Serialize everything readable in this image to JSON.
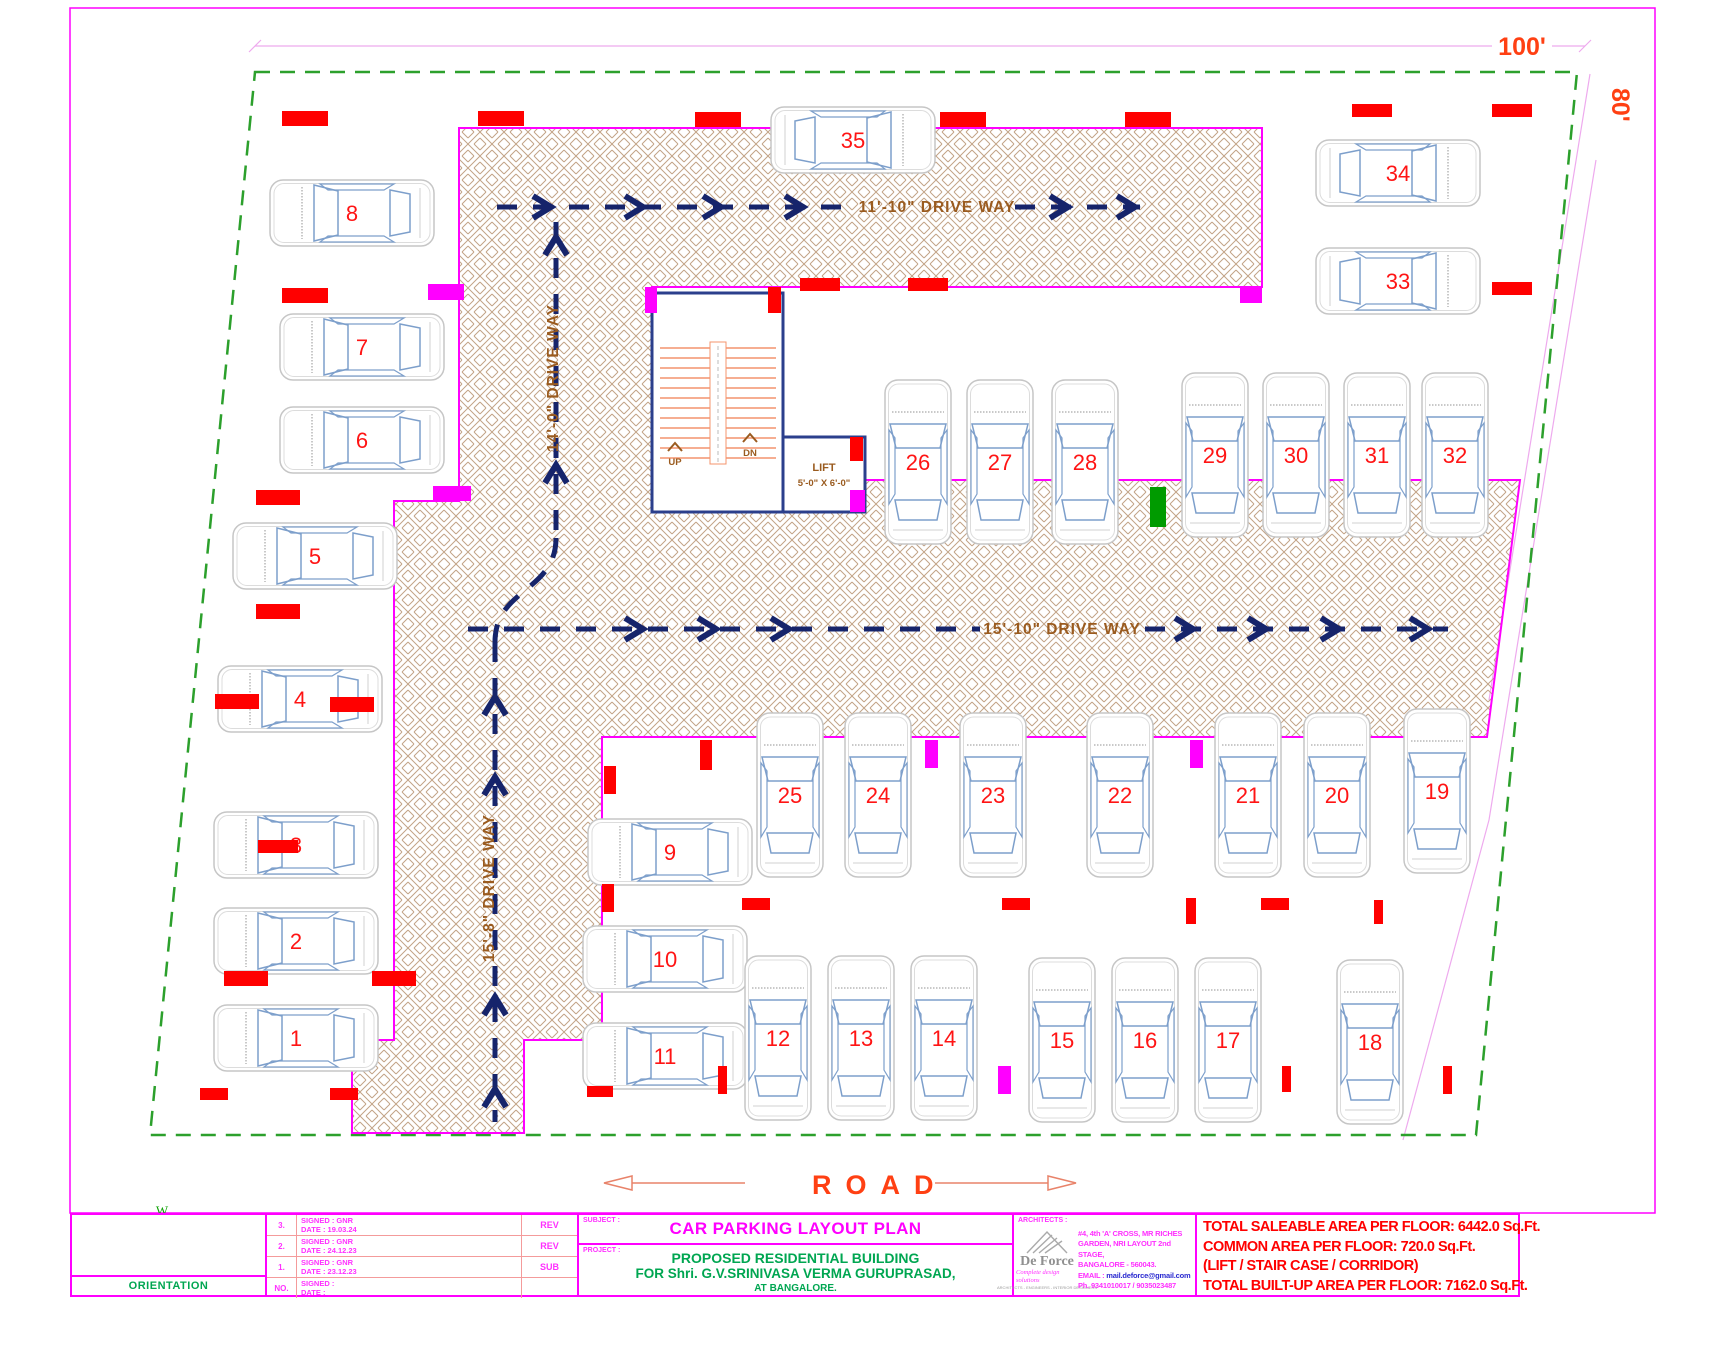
{
  "colors": {
    "magenta": "#ff00ff",
    "red": "#ff0000",
    "boundary_green": "#2ca02c",
    "column_green": "#009b00",
    "arrow_navy": "#16246b",
    "wall_navy": "#2b3f8c",
    "label_brown": "#9a5b1f",
    "hatch_tan": "#c2a386",
    "dim_pink": "#eeaaee",
    "orange_red": "#ff4013",
    "project_green": "#00a651",
    "car_gray": "#c6c6c6",
    "car_glass": "#7d9fcb"
  },
  "dims": {
    "top_label": "100'",
    "right_label": "80'"
  },
  "road": {
    "label": "ROAD"
  },
  "stair": {
    "up": "UP",
    "dn": "DN"
  },
  "lift": {
    "name": "LIFT",
    "size": "5'-0\" X 6'-0\""
  },
  "plan": {
    "driveway_labels": [
      {
        "label": "11'-10\" DRIVE WAY",
        "x": 937,
        "y": 212,
        "r": 0
      },
      {
        "label": "14'-0\" DRIVE WAY",
        "x": 558,
        "y": 378,
        "r": -90
      },
      {
        "label": "15'-10\" DRIVE WAY",
        "x": 1062,
        "y": 634,
        "r": 0
      },
      {
        "label": "15'-8\" DRIVE WAY",
        "x": 494,
        "y": 888,
        "r": -90
      }
    ],
    "spots": [
      [
        1,
        296,
        1038,
        "h",
        0
      ],
      [
        2,
        296,
        941,
        "h",
        0
      ],
      [
        3,
        296,
        845,
        "h",
        0
      ],
      [
        4,
        300,
        699,
        "h",
        0
      ],
      [
        5,
        315,
        556,
        "h",
        0
      ],
      [
        6,
        362,
        440,
        "h",
        0
      ],
      [
        7,
        362,
        347,
        "h",
        0
      ],
      [
        8,
        352,
        213,
        "h",
        0
      ],
      [
        9,
        670,
        852,
        "h",
        0
      ],
      [
        10,
        665,
        959,
        "h",
        0
      ],
      [
        11,
        665,
        1056,
        "h",
        0
      ],
      [
        12,
        778,
        1038,
        "v",
        0
      ],
      [
        13,
        861,
        1038,
        "v",
        0
      ],
      [
        14,
        944,
        1038,
        "v",
        0
      ],
      [
        15,
        1062,
        1040,
        "v",
        0
      ],
      [
        16,
        1145,
        1040,
        "v",
        0
      ],
      [
        17,
        1228,
        1040,
        "v",
        0
      ],
      [
        18,
        1370,
        1042,
        "v",
        0
      ],
      [
        19,
        1437,
        791,
        "v",
        0
      ],
      [
        20,
        1337,
        795,
        "v",
        0
      ],
      [
        21,
        1248,
        795,
        "v",
        0
      ],
      [
        22,
        1120,
        795,
        "v",
        0
      ],
      [
        23,
        993,
        795,
        "v",
        0
      ],
      [
        24,
        878,
        795,
        "v",
        0
      ],
      [
        25,
        790,
        795,
        "v",
        0
      ],
      [
        26,
        918,
        462,
        "v",
        0
      ],
      [
        27,
        1000,
        462,
        "v",
        0
      ],
      [
        28,
        1085,
        462,
        "v",
        0
      ],
      [
        29,
        1215,
        455,
        "v",
        0
      ],
      [
        30,
        1296,
        455,
        "v",
        0
      ],
      [
        31,
        1377,
        455,
        "v",
        0
      ],
      [
        32,
        1455,
        455,
        "v",
        0
      ],
      [
        33,
        1398,
        281,
        "h",
        1
      ],
      [
        34,
        1398,
        173,
        "h",
        1
      ],
      [
        35,
        853,
        140,
        "h",
        1
      ]
    ],
    "columns": [
      [
        282,
        111,
        46,
        15,
        "R"
      ],
      [
        478,
        111,
        46,
        15,
        "R"
      ],
      [
        695,
        112,
        46,
        15,
        "R"
      ],
      [
        940,
        112,
        46,
        15,
        "R"
      ],
      [
        1125,
        112,
        46,
        15,
        "R"
      ],
      [
        1352,
        104,
        40,
        13,
        "R"
      ],
      [
        1492,
        104,
        40,
        13,
        "R"
      ],
      [
        1492,
        282,
        40,
        13,
        "R"
      ],
      [
        282,
        288,
        46,
        15,
        "R"
      ],
      [
        428,
        284,
        36,
        16,
        "M"
      ],
      [
        256,
        490,
        44,
        15,
        "R"
      ],
      [
        433,
        486,
        38,
        15,
        "M"
      ],
      [
        256,
        604,
        44,
        15,
        "R"
      ],
      [
        215,
        694,
        44,
        15,
        "R"
      ],
      [
        330,
        697,
        44,
        15,
        "R"
      ],
      [
        258,
        840,
        40,
        13,
        "R"
      ],
      [
        224,
        971,
        44,
        15,
        "R"
      ],
      [
        372,
        971,
        44,
        15,
        "R"
      ],
      [
        200,
        1088,
        28,
        12,
        "R"
      ],
      [
        330,
        1088,
        28,
        12,
        "R"
      ],
      [
        645,
        287,
        12,
        26,
        "M"
      ],
      [
        768,
        287,
        13,
        26,
        "R"
      ],
      [
        800,
        278,
        40,
        13,
        "R"
      ],
      [
        908,
        278,
        40,
        13,
        "R"
      ],
      [
        1240,
        287,
        22,
        16,
        "M"
      ],
      [
        850,
        437,
        13,
        24,
        "R"
      ],
      [
        850,
        490,
        15,
        22,
        "M"
      ],
      [
        1150,
        487,
        16,
        40,
        "G"
      ],
      [
        604,
        766,
        12,
        28,
        "R"
      ],
      [
        700,
        740,
        12,
        30,
        "R"
      ],
      [
        925,
        740,
        13,
        28,
        "M"
      ],
      [
        1190,
        740,
        13,
        28,
        "M"
      ],
      [
        742,
        898,
        28,
        12,
        "R"
      ],
      [
        1002,
        898,
        28,
        12,
        "R"
      ],
      [
        1186,
        898,
        10,
        26,
        "R"
      ],
      [
        1261,
        898,
        28,
        12,
        "R"
      ],
      [
        1374,
        900,
        9,
        24,
        "R"
      ],
      [
        602,
        884,
        12,
        28,
        "R"
      ],
      [
        998,
        1066,
        13,
        28,
        "M"
      ],
      [
        718,
        1066,
        9,
        28,
        "R"
      ],
      [
        1282,
        1066,
        9,
        26,
        "R"
      ],
      [
        1443,
        1066,
        9,
        28,
        "R"
      ],
      [
        587,
        1086,
        26,
        11,
        "R"
      ]
    ],
    "chevrons": [
      [
        548,
        207,
        0
      ],
      [
        640,
        207,
        0
      ],
      [
        718,
        207,
        0
      ],
      [
        800,
        207,
        0
      ],
      [
        1065,
        207,
        0
      ],
      [
        1132,
        207,
        0
      ],
      [
        556,
        240,
        -90
      ],
      [
        556,
        468,
        -90
      ],
      [
        495,
        700,
        -90
      ],
      [
        495,
        780,
        -90
      ],
      [
        495,
        1000,
        -90
      ],
      [
        495,
        1092,
        -90
      ],
      [
        640,
        629,
        0
      ],
      [
        713,
        629,
        0
      ],
      [
        786,
        629,
        0
      ],
      [
        1190,
        629,
        0
      ],
      [
        1263,
        629,
        0
      ],
      [
        1336,
        629,
        0
      ],
      [
        1425,
        629,
        0
      ]
    ]
  },
  "titleblock": {
    "orientation_label": "ORIENTATION",
    "compass": {
      "w": "W",
      "n": "N",
      "s": "S",
      "e": "E"
    },
    "revisions": [
      {
        "no": "3.",
        "signed": "SIGNED : GNR",
        "date": "DATE : 19.03.24",
        "type": "REV"
      },
      {
        "no": "2.",
        "signed": "SIGNED : GNR",
        "date": "DATE : 24.12.23",
        "type": "REV"
      },
      {
        "no": "1.",
        "signed": "SIGNED : GNR",
        "date": "DATE : 23.12.23",
        "type": "SUB"
      },
      {
        "no": "NO.",
        "signed": "SIGNED :",
        "date": "DATE :",
        "type": ""
      }
    ],
    "subject_label": "SUBJECT :",
    "subject": "CAR PARKING LAYOUT PLAN",
    "project_label": "PROJECT :",
    "project_line1": "PROPOSED RESIDENTIAL BUILDING",
    "project_line2": "FOR Shri. G.V.SRINIVASA VERMA GURUPRASAD,",
    "project_line3": "AT BANGALORE.",
    "architects_label": "ARCHITECTS :",
    "firm_name": "De Force",
    "firm_tagline": "Complete design solutions",
    "firm_sub": "ARCHITECTS - ENGINEERS - INTERIOR DESIGNERS",
    "address_line1": "#4, 4th 'A' CROSS, MR RICHES",
    "address_line2": "GARDEN, NRI LAYOUT 2nd STAGE,",
    "address_line3": "BANGALORE - 560043.",
    "email_label": "EMAIL :",
    "email": "mail.deforce@gmail.com",
    "phone": "Ph. 9341010017 / 9035023487",
    "totals": [
      "TOTAL SALEABLE AREA PER FLOOR: 6442.0 Sq.Ft.",
      "COMMON AREA PER FLOOR: 720.0 Sq.Ft.",
      "(LIFT / STAIR CASE / CORRIDOR)",
      "TOTAL BUILT-UP AREA PER FLOOR: 7162.0 Sq.Ft."
    ]
  }
}
